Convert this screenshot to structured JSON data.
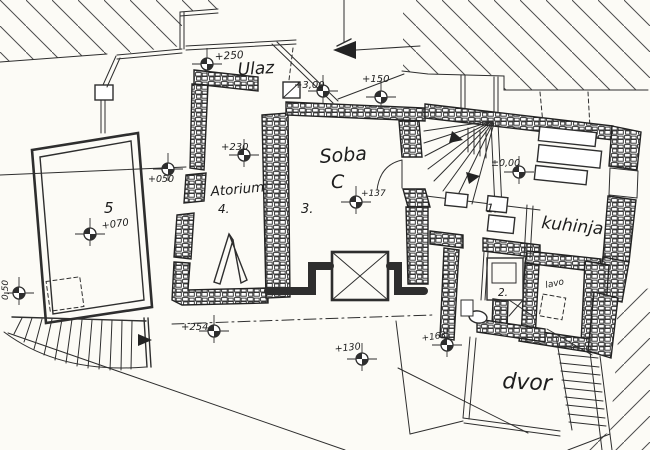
{
  "document": {
    "type": "scanned hand-drawn architectural floor plan",
    "language": "Croatian",
    "paper_color": "#fcfbf6",
    "ink_color": "#2e2e2e"
  },
  "rooms": [
    {
      "id": "ulaz",
      "label": "Ulaz"
    },
    {
      "id": "soba-c",
      "label": "Soba",
      "letter": "C",
      "number": "3."
    },
    {
      "id": "atorium",
      "label": "Atorium",
      "number": "4."
    },
    {
      "id": "terasa",
      "label": "5"
    },
    {
      "id": "prostorija-1",
      "label": "1."
    },
    {
      "id": "kuhinja",
      "label": "kuhinja"
    },
    {
      "id": "prostorija-2",
      "label": "2."
    },
    {
      "id": "lavo",
      "label": "lavo"
    },
    {
      "id": "dvor",
      "label": "dvor"
    }
  ],
  "elevation_markers": [
    {
      "label": "+250"
    },
    {
      "label": "+3,00"
    },
    {
      "label": "+150"
    },
    {
      "label": "+230"
    },
    {
      "label": "+050"
    },
    {
      "label": "+070"
    },
    {
      "label": "+137"
    },
    {
      "label": "±0,00"
    },
    {
      "label": "+254"
    },
    {
      "label": "+130"
    },
    {
      "label": "+163"
    },
    {
      "label": "0,50"
    }
  ]
}
